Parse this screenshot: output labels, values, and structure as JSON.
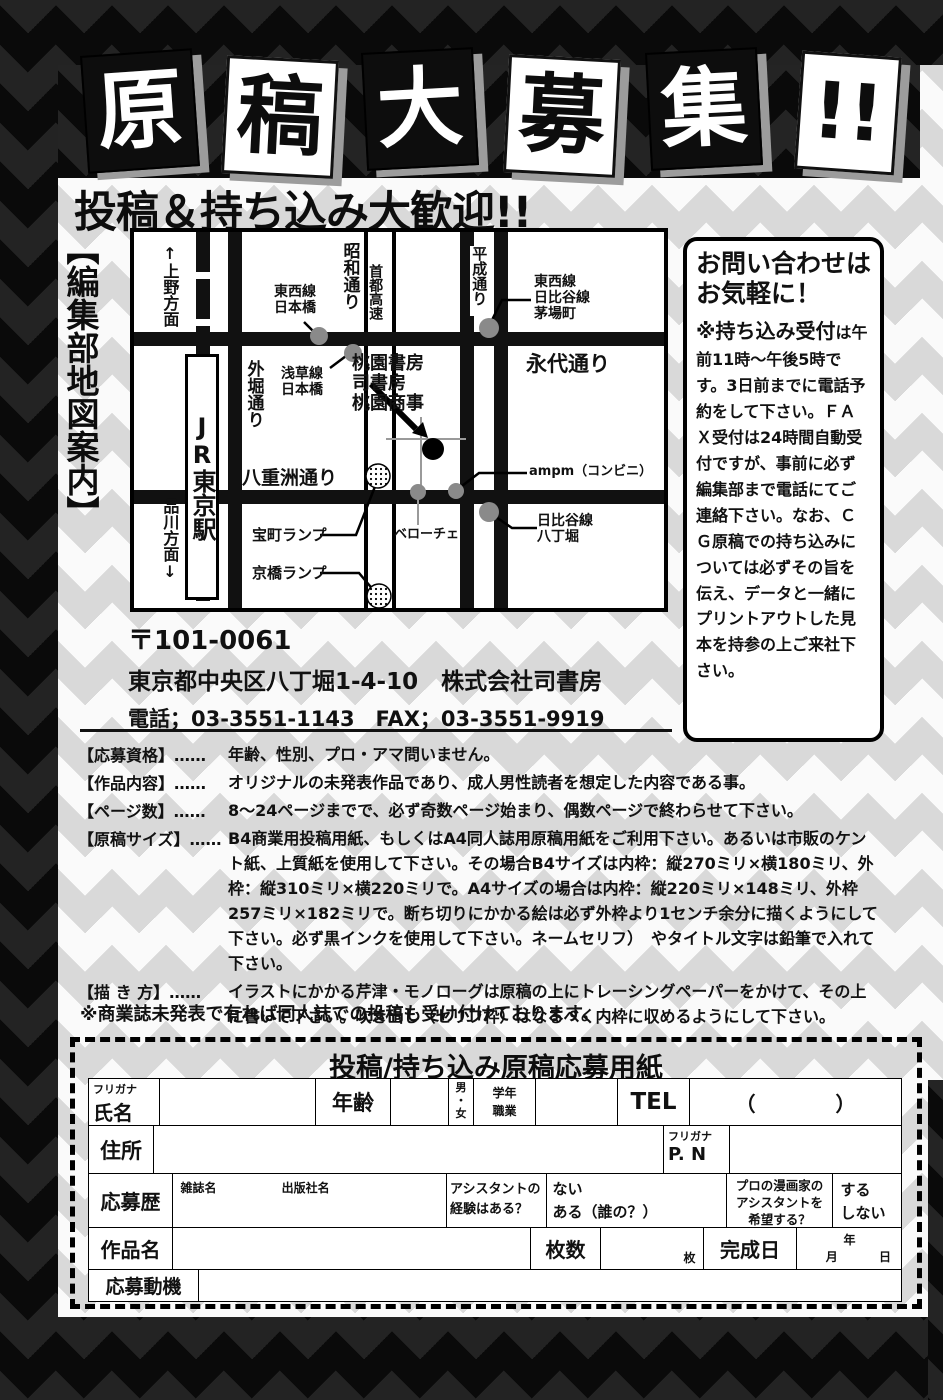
{
  "title": {
    "cards": [
      "原",
      "稿",
      "大",
      "募",
      "集",
      "!!"
    ],
    "subtitle": "投稿＆持ち込み大歓迎!!"
  },
  "map": {
    "side_label": "【編集部地図案内】",
    "direction_up": "↑上野方面",
    "direction_down": "品川方面↓",
    "station": "JR東京駅",
    "roads": {
      "showa": "昭和通り",
      "sotobori": "外堀通り",
      "shuto": "首都高速",
      "heisei": "平成通り",
      "eitai": "永代通り",
      "yaesu": "八重洲通り"
    },
    "points": {
      "tozai_nihonbashi": "東西線\n日本橋",
      "asakusa_nihonbashi": "浅草線\n日本橋",
      "kayabacho": "東西線\n日比谷線\n茅場町",
      "office": "桃園書房\n司書房\n桃園商事",
      "ampm": "ampm（コンビニ）",
      "veloce": "ベローチェ",
      "hatchobori": "日比谷線\n八丁堀",
      "takaracho": "宝町ランプ",
      "kyobashi": "京橋ランプ"
    }
  },
  "contact": {
    "title_line1": "お問い合わせは",
    "title_line2": "お気軽に！",
    "lead": "※持ち込み受付",
    "body": "は午前11時～午後5時です。3日前までに電話予約をして下さい。ＦＡＸ受付は24時間自動受付ですが、事前に必ず編集部まで電話にてご連絡下さい。なお、ＣＧ原稿での持ち込みについては必ずその旨を伝え、データと一緒にプリントアウトした見本を持参の上ご来社下さい。"
  },
  "address": {
    "postal": "〒101-0061",
    "line1": "東京都中央区八丁堀1-4-10　株式会社司書房",
    "line2": "電話；03-3551-1143　FAX；03-3551-9919"
  },
  "specs": [
    {
      "label": "【応募資格】……",
      "text": "年齢、性別、プロ・アマ問いません。"
    },
    {
      "label": "【作品内容】……",
      "text": "オリジナルの未発表作品であり、成人男性読者を想定した内容である事。"
    },
    {
      "label": "【ページ数】……",
      "text": "8～24ページまでで、必ず奇数ページ始まり、偶数ページで終わらせて下さい。"
    },
    {
      "label": "【原稿サイズ】……",
      "text": "B4商業用投稿用紙、もしくはA4同人誌用原稿用紙をご利用下さい。あるいは市販のケント紙、上質紙を使用して下さい。その場合B4サイズは内枠：縦270ミリ×横180ミリ、外枠：縦310ミリ×横220ミリで。A4サイズの場合は内枠：縦220ミリ×148ミリ、外枠257ミリ×182ミリで。断ち切りにかかる絵は必ず外枠より1センチ余分に描くようにして下さい。必ず黒インクを使用して下さい。ネームセリフ）　やタイトル文字は鉛筆で入れて下さい。"
    },
    {
      "label": "【描 き 方】……",
      "text": "イラストにかかる芹津・モノローグは原稿の上にトレーシングペーパーをかけて、その上に書いて下さい。吹き出し（セリフ枠）はなるべく内枠に収めるようにして下さい。"
    }
  ],
  "note": "※商業誌未発表で有れば同人誌での投稿も受け付けております。",
  "form": {
    "title": "投稿/持ち込み原稿応募用紙",
    "furigana": "フリガナ",
    "name": "氏名",
    "age": "年齢",
    "gender": "男\n・\n女",
    "grade_job": "学年\n職業",
    "tel": "TEL",
    "tel_paren": "（　　　　）",
    "address_label": "住所",
    "pn_furigana": "フリガナ",
    "pn": "P. N",
    "history": "応募歴",
    "magazine": "雑誌名",
    "publisher": "出版社名",
    "assistant_q": "アシスタントの\n経験はある？",
    "assistant_a": "ない\nある（誰の？）",
    "pro_q": "プロの漫画家の\nアシスタントを\n希望する？",
    "pro_a": "する\n しない",
    "work_title": "作品名",
    "pages": "枚数",
    "pages_unit": "枚",
    "completion": "完成日",
    "year": "年",
    "month": "月",
    "day": "日",
    "motivation": "応募動機"
  }
}
